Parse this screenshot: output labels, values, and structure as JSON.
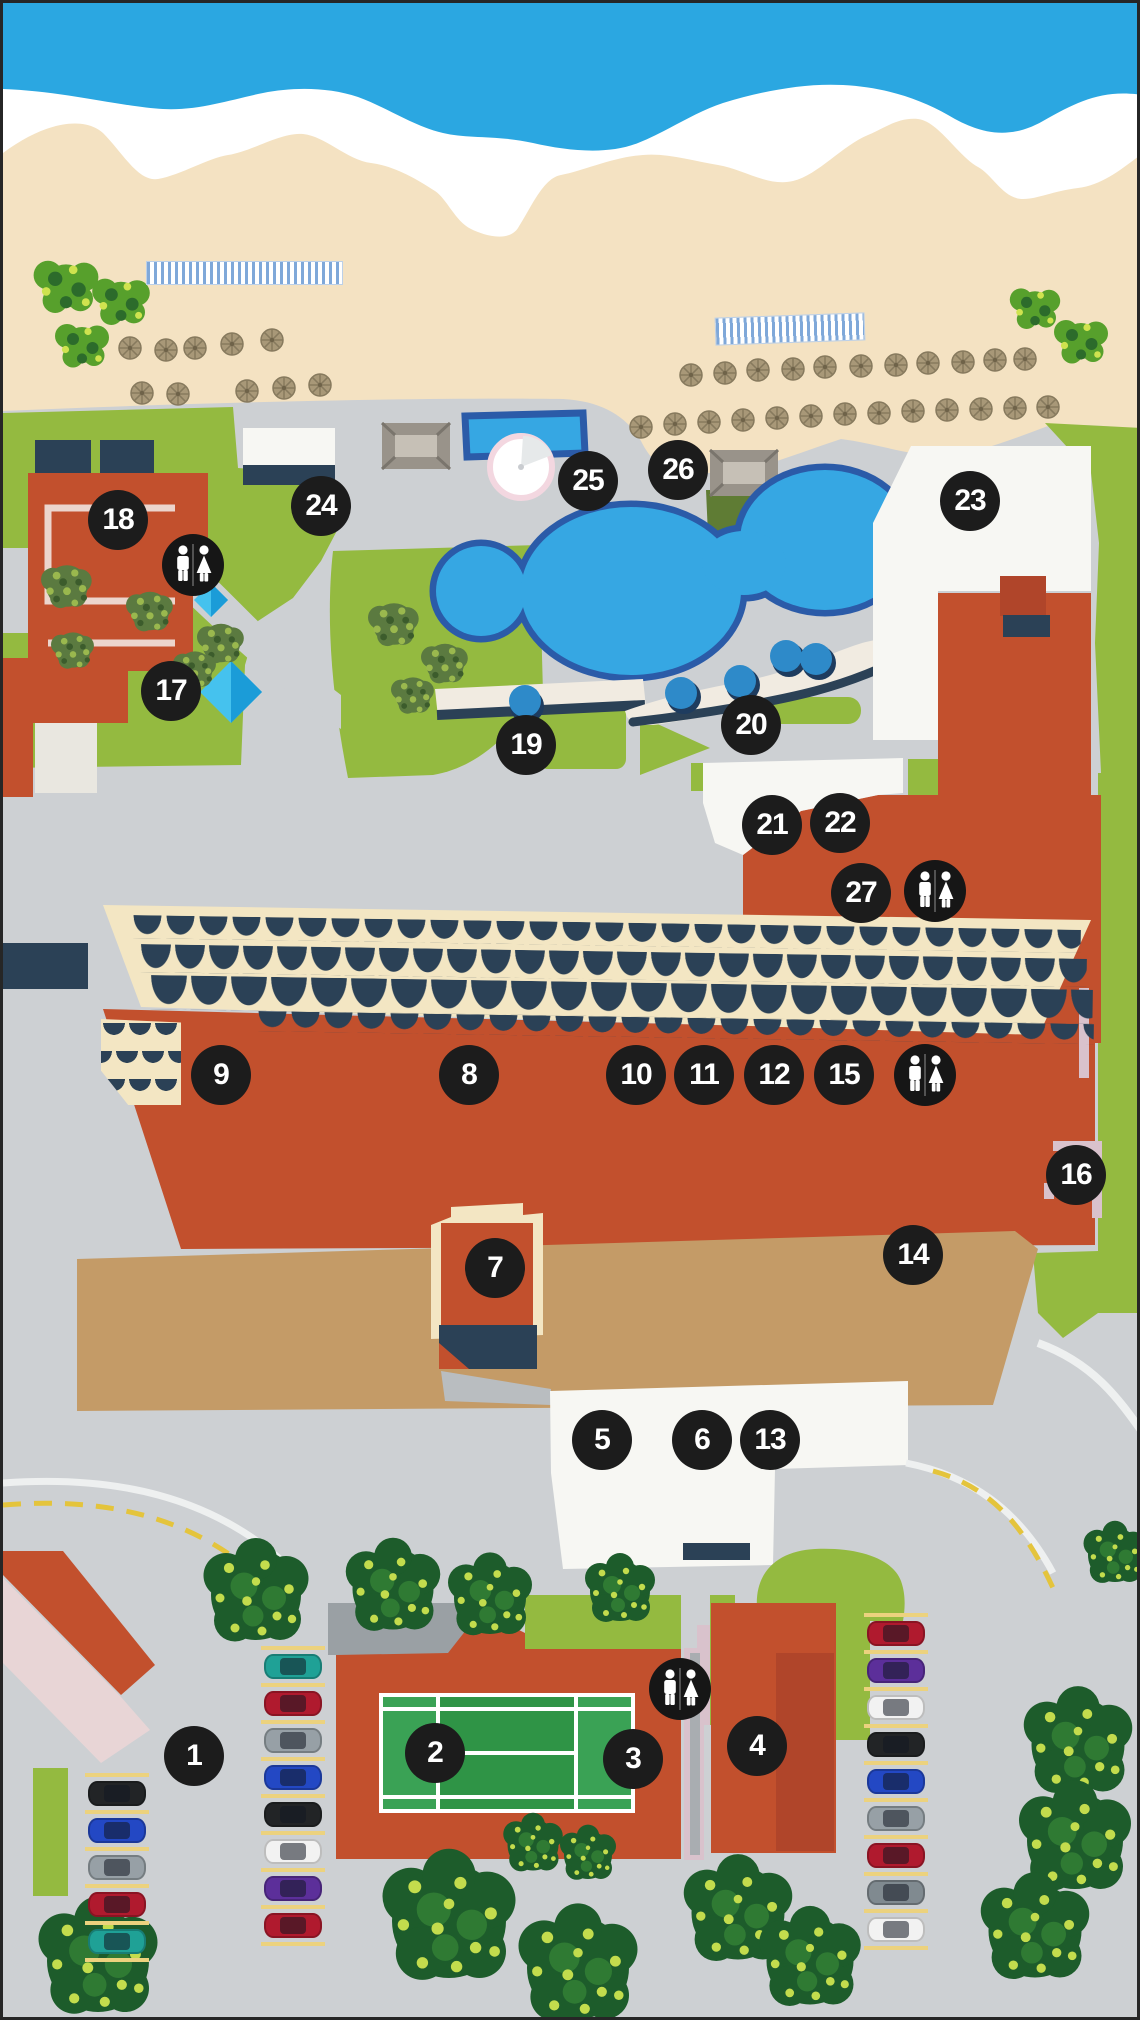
{
  "map": {
    "palette": {
      "ocean": "#2ba7e1",
      "foam": "#ffffff",
      "sand": "#f4e2c2",
      "grass": "#94ba40",
      "ground": "#cdd0d3",
      "pool_water": "#36a7e3",
      "pool_edge": "#2b5ba8",
      "building_red": "#c2502d",
      "terrace_cream": "#f3e6c3",
      "awning_navy": "#2b4156",
      "terrace_tan": "#c49b67",
      "white_building": "#f7f7f3",
      "marker_bg": "#1c1c1c",
      "marker_text": "#ffffff"
    },
    "markers": [
      {
        "label": "1",
        "x": 191,
        "y": 1753
      },
      {
        "label": "2",
        "x": 432,
        "y": 1750
      },
      {
        "label": "3",
        "x": 630,
        "y": 1756
      },
      {
        "label": "4",
        "x": 754,
        "y": 1743
      },
      {
        "label": "5",
        "x": 599,
        "y": 1437
      },
      {
        "label": "6",
        "x": 699,
        "y": 1437
      },
      {
        "label": "7",
        "x": 492,
        "y": 1265
      },
      {
        "label": "8",
        "x": 466,
        "y": 1072
      },
      {
        "label": "9",
        "x": 218,
        "y": 1072
      },
      {
        "label": "10",
        "x": 633,
        "y": 1072
      },
      {
        "label": "11",
        "x": 701,
        "y": 1072
      },
      {
        "label": "12",
        "x": 771,
        "y": 1072
      },
      {
        "label": "13",
        "x": 767,
        "y": 1437
      },
      {
        "label": "14",
        "x": 910,
        "y": 1252
      },
      {
        "label": "15",
        "x": 841,
        "y": 1072
      },
      {
        "label": "16",
        "x": 1073,
        "y": 1172
      },
      {
        "label": "17",
        "x": 168,
        "y": 688
      },
      {
        "label": "18",
        "x": 115,
        "y": 517
      },
      {
        "label": "19",
        "x": 523,
        "y": 742
      },
      {
        "label": "20",
        "x": 748,
        "y": 722
      },
      {
        "label": "21",
        "x": 769,
        "y": 822
      },
      {
        "label": "22",
        "x": 837,
        "y": 820
      },
      {
        "label": "23",
        "x": 967,
        "y": 498
      },
      {
        "label": "24",
        "x": 318,
        "y": 503
      },
      {
        "label": "25",
        "x": 585,
        "y": 478
      },
      {
        "label": "26",
        "x": 675,
        "y": 467
      },
      {
        "label": "27",
        "x": 858,
        "y": 890
      }
    ],
    "restrooms": [
      {
        "x": 190,
        "y": 562
      },
      {
        "x": 932,
        "y": 888
      },
      {
        "x": 922,
        "y": 1072
      },
      {
        "x": 677,
        "y": 1686
      }
    ],
    "parking": {
      "columns": [
        {
          "x": 114,
          "y_top": 1770,
          "colors": [
            "#222426",
            "#2348c4",
            "#97a0a6",
            "#b01a2e",
            "#1fa196"
          ]
        },
        {
          "x": 290,
          "y_top": 1643,
          "colors": [
            "#1fa196",
            "#b01a2e",
            "#97a0a6",
            "#2348c4",
            "#222426",
            "#f2f2f2",
            "#5c2f9a",
            "#b01a2e"
          ]
        },
        {
          "x": 893,
          "y_top": 1610,
          "colors": [
            "#b01a2e",
            "#5c2f9a",
            "#f2f2f2",
            "#222426",
            "#2348c4",
            "#97a0a6",
            "#b01a2e",
            "#808a90",
            "#f2f2f2"
          ]
        }
      ]
    }
  }
}
